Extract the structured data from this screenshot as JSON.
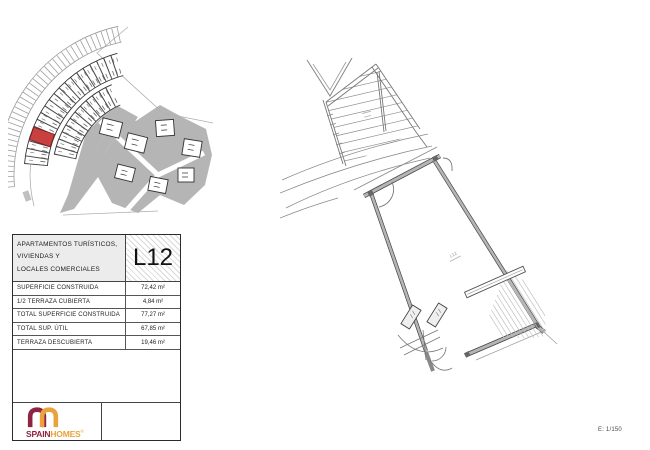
{
  "page": {
    "scale_label": "E: 1/150"
  },
  "panel": {
    "header": {
      "title_lines": [
        "APARTAMENTOS TURÍSTICOS,",
        "VIVIENDAS Y",
        "LOCALES COMERCIALES"
      ],
      "unit_code": "L12"
    },
    "rows": [
      {
        "label": "SUPERFICIE CONSTRUIDA",
        "value": "72,42 m²"
      },
      {
        "label": "1/2 TERRAZA CUBIERTA",
        "value": "4,84 m²"
      },
      {
        "label": "TOTAL SUPERFICIE CONSTRUIDA",
        "value": "77,27 m²"
      },
      {
        "label": "TOTAL SUP. ÚTIL",
        "value": "67,85 m²"
      },
      {
        "label": "TERRAZA DESCUBIERTA",
        "value": "19,46 m²"
      }
    ],
    "brand": {
      "part1": "SPAIN",
      "part2": "HOMES",
      "mark": "®",
      "color_primary": "#8e2342",
      "color_secondary": "#e8a33c"
    }
  },
  "site_plan": {
    "highlight_unit": "L12",
    "highlight_color": "#c94040"
  },
  "floor_plan": {
    "room_label": "L12"
  }
}
